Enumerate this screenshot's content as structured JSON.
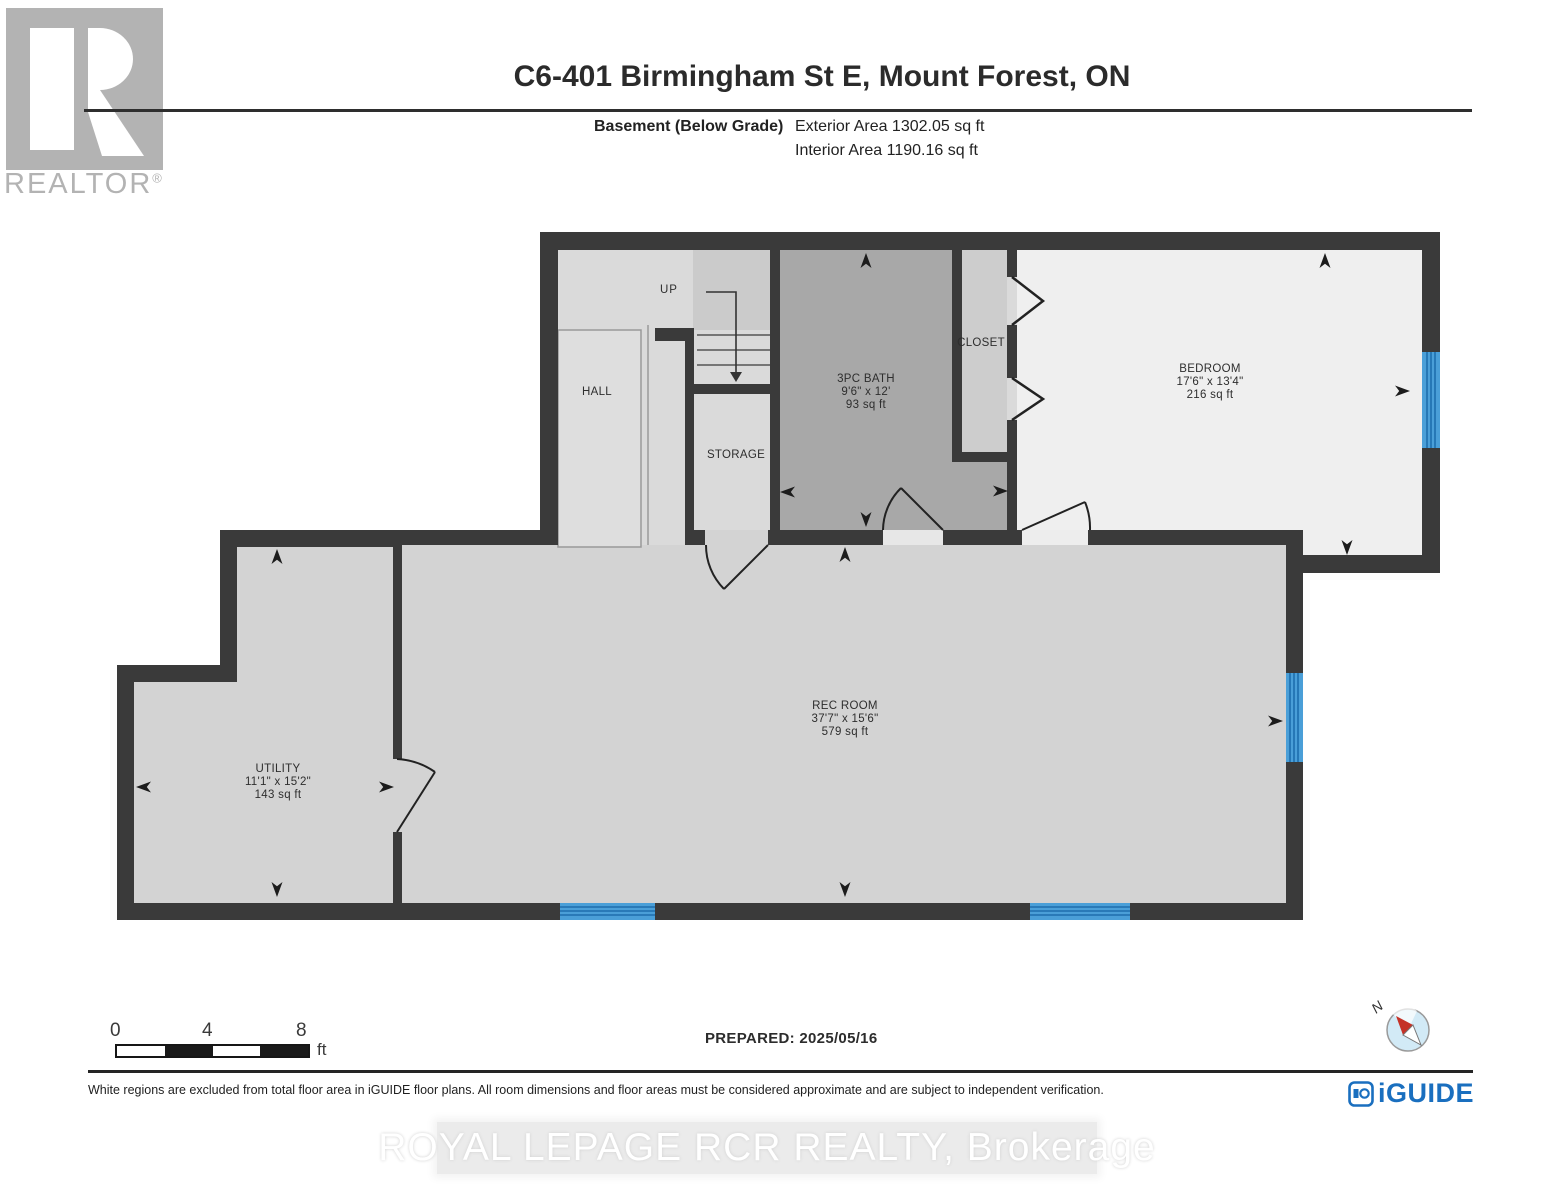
{
  "header": {
    "title": "C6-401 Birmingham St E, Mount Forest, ON",
    "floor_label": "Basement (Below Grade)",
    "exterior_area": "Exterior Area 1302.05 sq ft",
    "interior_area": "Interior Area 1190.16 sq ft",
    "realtor_logo_text": "REALTOR"
  },
  "rooms": [
    {
      "name": "HALL"
    },
    {
      "name": "STORAGE"
    },
    {
      "name": "3PC BATH",
      "dims": "9'6\" x 12'",
      "area": "93 sq ft"
    },
    {
      "name": "CLOSET"
    },
    {
      "name": "BEDROOM",
      "dims": "17'6\" x 13'4\"",
      "area": "216 sq ft"
    },
    {
      "name": "REC ROOM",
      "dims": "37'7\" x 15'6\"",
      "area": "579 sq ft"
    },
    {
      "name": "UTILITY",
      "dims": "11'1\" x 15'2\"",
      "area": "143 sq ft"
    }
  ],
  "stairs": {
    "up_label": "UP"
  },
  "scale_bar": {
    "start": "0",
    "mid": "4",
    "end": "8",
    "unit": "ft"
  },
  "prepared": "PREPARED: 2025/05/16",
  "compass": {
    "north_label": "N"
  },
  "footer": {
    "disclaimer": "White regions are excluded from total floor area in iGUIDE floor plans. All room dimensions and floor areas must be considered approximate and are subject to independent verification.",
    "brand": "iGUIDE"
  },
  "watermark": "ROYAL LEPAGE RCR REALTY, Brokerage",
  "colors": {
    "wall": "#3a3a3a",
    "window_blue": "#4a9fd8",
    "window_stripe": "#1e6fae",
    "bath_floor": "#a8a8a8",
    "bedroom_floor": "#efefef",
    "iguide_blue": "#1a6fbf",
    "compass_red": "#c43227",
    "logo_gray": "#b3b3b3"
  }
}
